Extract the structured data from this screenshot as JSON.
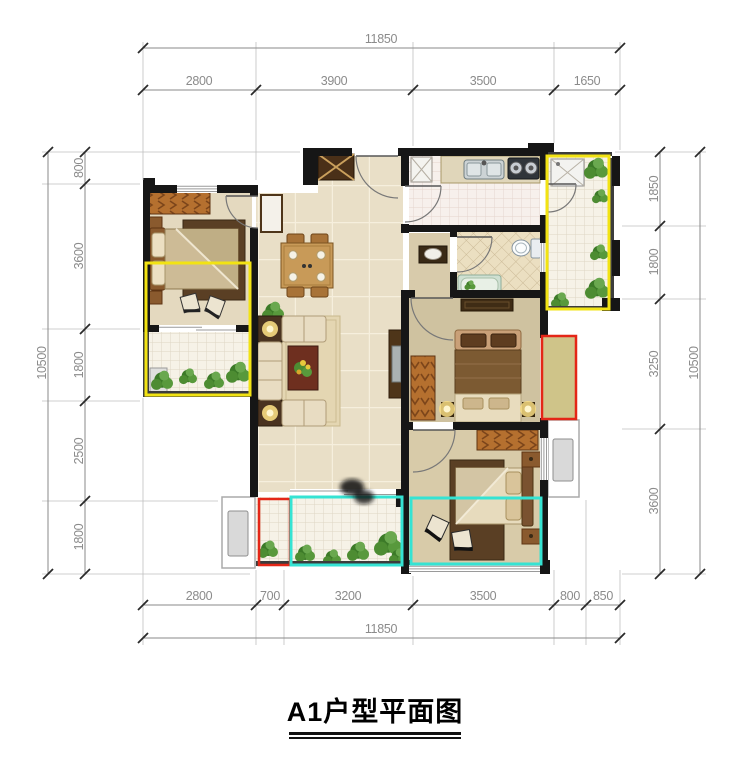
{
  "title": {
    "text": "A1户型平面图"
  },
  "dimensions": {
    "top": {
      "total": "11850",
      "segments": [
        "2800",
        "3900",
        "3500",
        "1650"
      ]
    },
    "bottom": {
      "total": "11850",
      "segments": [
        "2800",
        "700",
        "3200",
        "3500",
        "800",
        "850"
      ]
    },
    "left": {
      "total": "10500",
      "segments": [
        "800",
        "3600",
        "1800",
        "2500",
        "1800"
      ]
    },
    "right": {
      "total": "10500",
      "segments": [
        "1850",
        "1800",
        "3250",
        "3600"
      ]
    }
  },
  "highlight_colors": {
    "yellow": "#f2e313",
    "red": "#e42617",
    "cyan": "#35e3d3",
    "khaki_fill": "#cfc489"
  }
}
